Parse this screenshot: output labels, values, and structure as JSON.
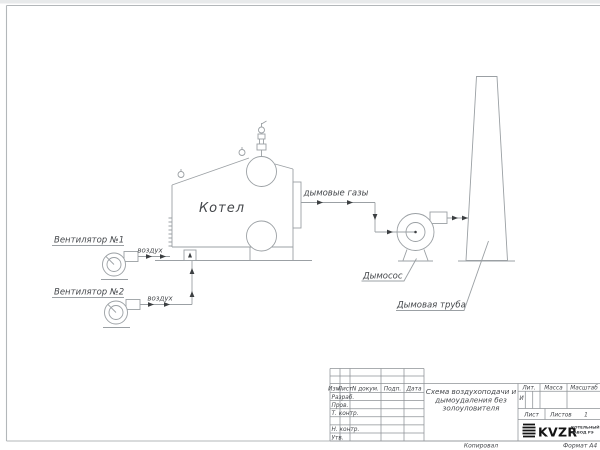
{
  "colors": {
    "page": "#ffffff",
    "line": "#9ba0a4",
    "dark_marks": "#3c3f42",
    "text": "#44474b",
    "logo_black": "#141414"
  },
  "diagram": {
    "boiler_label": "Котел",
    "fan1_label": "Вентилятор №1",
    "fan1_flow": "воздух",
    "fan2_label": "Вентилятор №2",
    "fan2_flow": "воздух",
    "flue_label": "дымовые газы",
    "exhauster_label": "Дымосос",
    "chimney_label": "Дымовая труба"
  },
  "title_block": {
    "col_izm": "Изм.",
    "col_list": "Лист",
    "col_doc": "N докум.",
    "col_podp": "Подп.",
    "col_data": "Дата",
    "row_razrab": "Разраб.",
    "row_prov": "Пров.",
    "row_tcontr": "Т. контр.",
    "row_ncontr": "Н. контр.",
    "row_utv": "Утв.",
    "title_line1": "Схема воздухоподачи и",
    "title_line2": "дымоудаления без",
    "title_line3": "золоуловителя",
    "lit": "Лит.",
    "lit_value": "И",
    "massa": "Масса",
    "masshtab": "Масштаб",
    "list": "Лист",
    "listov": "Листов",
    "listov_value": "1",
    "logo": "KVZR",
    "company_line1": "КОТЕЛЬНЫЙ",
    "company_line2": "ЗАВОД РЭ",
    "copied": "Копировал",
    "format": "Формат А4"
  }
}
